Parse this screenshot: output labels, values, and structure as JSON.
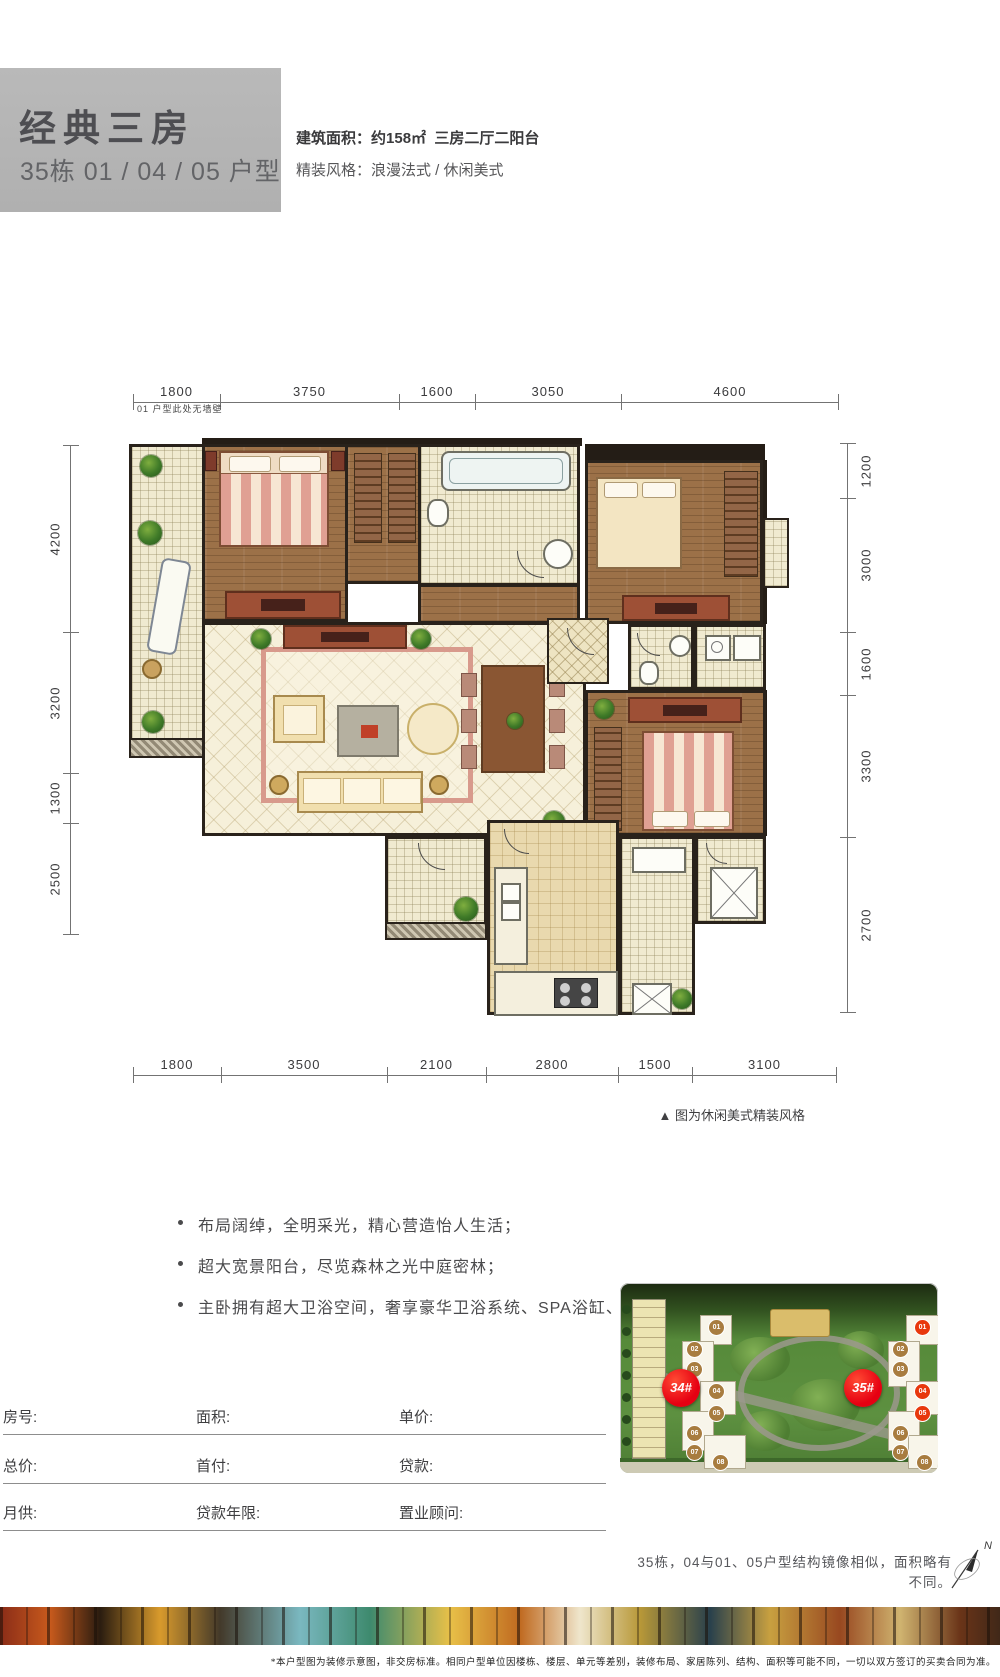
{
  "header": {
    "title": "经典三房",
    "subtitle": "35栋 01 / 04 / 05 户型",
    "spec_line1_label": "建筑面积：",
    "spec_line1_value": "约158㎡",
    "spec_line1_extra": "三房二厅二阳台",
    "spec_line2_label": "精装风格：",
    "spec_line2_value": "浪漫法式 / 休闲美式"
  },
  "floorplan": {
    "wall_note": "01 户型此处无墙壁",
    "caption": "▲ 图为休闲美式精装风格",
    "dims": {
      "top": [
        "1800",
        "3750",
        "1600",
        "3050",
        "4600"
      ],
      "bottom": [
        "1800",
        "3500",
        "2100",
        "2800",
        "1500",
        "3100"
      ],
      "left": [
        "4200",
        "3200",
        "1300",
        "2500"
      ],
      "right": [
        "1200",
        "3000",
        "1600",
        "3300",
        "2700"
      ]
    }
  },
  "features": {
    "items": [
      "布局阔绰，全明采光，精心营造怡人生活；",
      "超大宽景阳台，尽览森林之光中庭密林；",
      "主卧拥有超大卫浴空间，奢享豪华卫浴系统、SPA浴缸、步入式衣帽间等。"
    ]
  },
  "form": {
    "row1": {
      "c1": "房号:",
      "c2": "面积:",
      "c3": "单价:"
    },
    "row2": {
      "c1": "总价:",
      "c2": "首付:",
      "c3": "贷款:"
    },
    "row3": {
      "c1": "月供:",
      "c2": "贷款年限:",
      "c3": "置业顾问:"
    }
  },
  "siteplan": {
    "badge_left": "34#",
    "badge_right": "35#",
    "units_left": [
      "01",
      "02",
      "03",
      "04",
      "05",
      "06",
      "07",
      "08"
    ],
    "units_right": [
      "01",
      "02",
      "03",
      "04",
      "05",
      "06",
      "07",
      "08"
    ],
    "highlighted_units": [
      "01",
      "04",
      "05"
    ],
    "caption": "35栋，04与01、05户型结构镜像相似，面积略有不同。",
    "north_label": "N"
  },
  "footer": {
    "disclaimer": "*本户型图为装修示意图，非交房标准。相同户型单位因楼栋、楼层、单元等差别，装修布局、家居陈列、结构、面积等可能不同，一切以双方签订的买卖合同为准。"
  },
  "colors": {
    "header_box": "#b5b5b5",
    "badge_red": "#e60012",
    "unit_circle": "#a87c3f",
    "unit_highlight": "#e8380d",
    "wood_floor": "#9c7148",
    "cream_tile": "#f0ead0",
    "wall": "#29221b"
  }
}
